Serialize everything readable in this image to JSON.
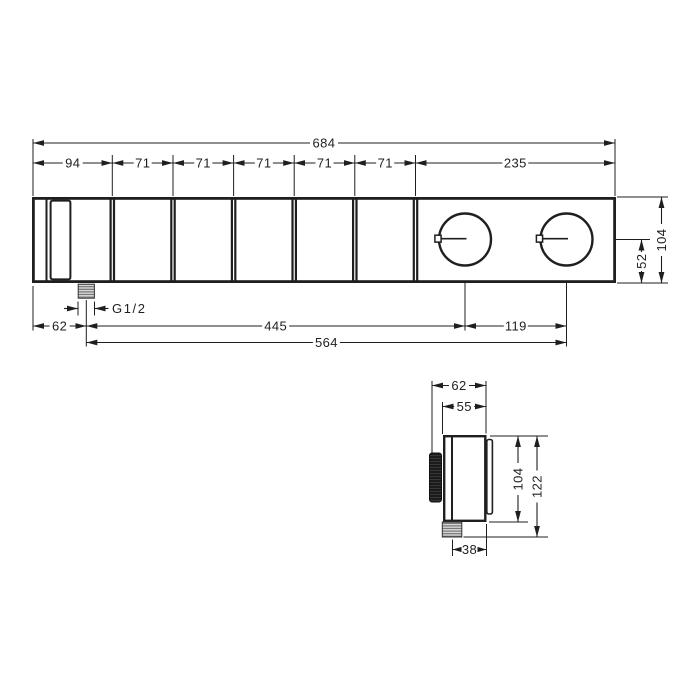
{
  "front_view": {
    "overall_width": "684",
    "segments": [
      "94",
      "71",
      "71",
      "71",
      "71",
      "71",
      "235"
    ],
    "height": "104",
    "handle_axis_from_bottom": "52",
    "outlet_from_left": "62",
    "outlet_to_handle1": "445",
    "handle_spacing": "119",
    "outlet_to_handle2": "564",
    "thread": "G1/2"
  },
  "side_view": {
    "depth_overall": "62",
    "depth_body": "55",
    "height_body": "104",
    "height_overall": "122",
    "outlet_from_wall": "38"
  },
  "colors": {
    "line": "#1f1f1f",
    "handle_dark": "#1b1b1b",
    "hatch_bg": "#d9d9d9",
    "hatch_line": "#6b6b6b"
  }
}
